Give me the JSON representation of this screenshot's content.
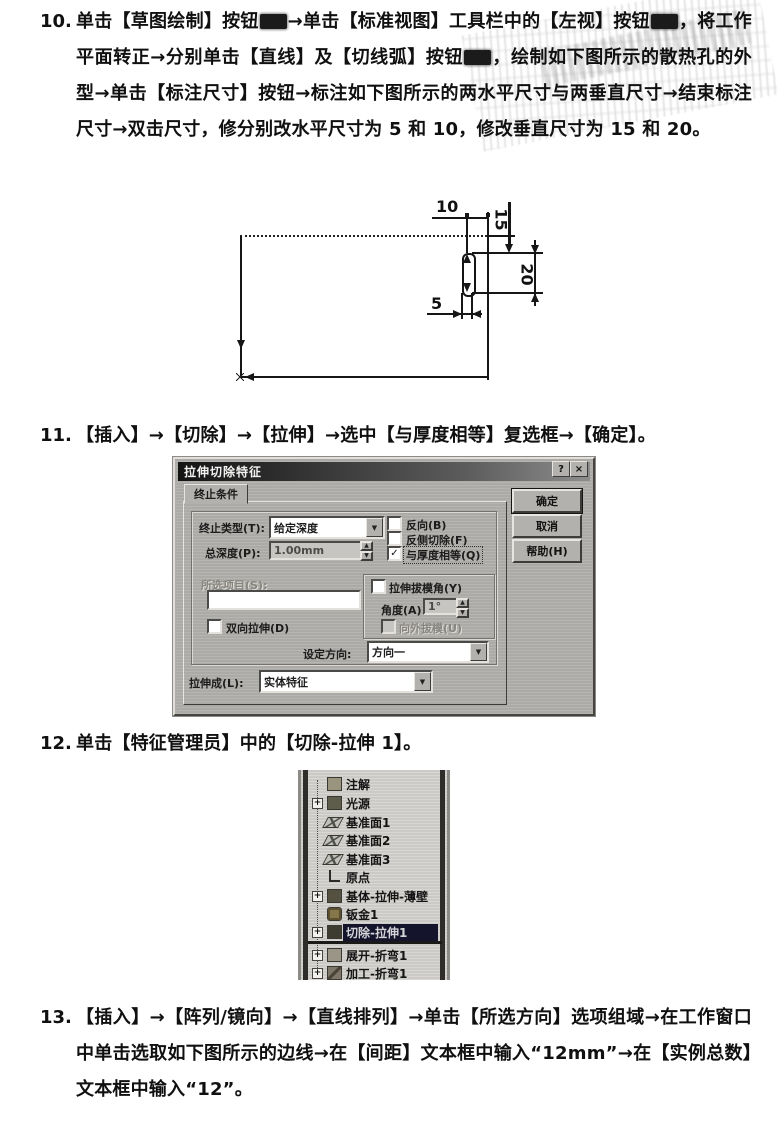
{
  "colors": {
    "paper": "#ffffff",
    "ink": "#101010",
    "dialog_bg": "#b3b1ad",
    "title_bar": "#1c1c1c",
    "selection_bg": "#14142c"
  },
  "icons": {
    "dropdown": "▼",
    "help": "?",
    "close": "×",
    "spinner_up": "▲",
    "spinner_down": "▼",
    "check": "✓",
    "plus": "+"
  },
  "steps": {
    "s10": {
      "num": "10.",
      "seg1": "单击【草图绘制】按钮",
      "seg2": "→单击【标准视图】工具栏中的【左视】按钮",
      "seg3": "，将工作平面转正→分别单击【直线】及【切线弧】按钮",
      "seg4": "，绘制如下图所示的散热孔的外型→单击【标注尺寸】按钮→标注如下图所示的两水平尺寸与两垂直尺寸→结束标注尺寸→双击尺寸，修分别改水平尺寸为 5 和 10，修改垂直尺寸为 15 和 20。"
    },
    "s11": {
      "num": "11.",
      "text": "【插入】→【切除】→【拉伸】→选中【与厚度相等】复选框→【确定】。"
    },
    "s12": {
      "num": "12.",
      "text": "单击【特征管理员】中的【切除-拉伸 1】。"
    },
    "s13": {
      "num": "13.",
      "text": "【插入】→【阵列/镜向】→【直线排列】→单击【所选方向】选项组域→在工作窗口中单击选取如下图所示的边线→在【间距】文本框中输入“12mm”→在【实例总数】文本框中输入“12”。"
    }
  },
  "drawing": {
    "d10": "10",
    "d15": "15",
    "d20": "20",
    "d5": "5"
  },
  "dialog": {
    "title": "拉伸切除特征",
    "tab": "终止条件",
    "end_type_label": "终止类型(T):",
    "end_type_value": "给定深度",
    "depth_label": "总深度(P):",
    "depth_value": "1.00mm",
    "cb_reverse": "反向(B)",
    "cb_flip_side": "反侧切除(F)",
    "cb_link_thickness": "与厚度相等(Q)",
    "selected_items_label": "所选项目(S):",
    "cb_both_directions": "双向拉伸(D)",
    "cb_draft": "拉伸拔模角(Y)",
    "angle_label": "角度(A)",
    "angle_value": "1°",
    "cb_draft_outward": "向外拔模(U)",
    "direction_label": "设定方向:",
    "direction_value": "方向一",
    "extrude_as_label": "拉伸成(L):",
    "extrude_as_value": "实体特征",
    "btn_ok": "确定",
    "btn_cancel": "取消",
    "btn_help": "帮助(H)"
  },
  "tree": {
    "items": [
      {
        "label": "注解",
        "icon": "annotations-icon"
      },
      {
        "label": "光源",
        "icon": "lighting-icon"
      },
      {
        "label": "基准面1",
        "icon": "plane-icon"
      },
      {
        "label": "基准面2",
        "icon": "plane-icon"
      },
      {
        "label": "基准面3",
        "icon": "plane-icon"
      },
      {
        "label": "原点",
        "icon": "origin-icon"
      },
      {
        "label": "基体-拉伸-薄壁",
        "icon": "base-extrude-thin-icon"
      },
      {
        "label": "钣金1",
        "icon": "sheet-metal-icon"
      },
      {
        "label": "切除-拉伸1",
        "icon": "cut-extrude-icon",
        "selected": true
      },
      {
        "label": "展开-折弯1",
        "icon": "flatten-bends-icon"
      },
      {
        "label": "加工-折弯1",
        "icon": "process-bends-icon"
      }
    ]
  }
}
